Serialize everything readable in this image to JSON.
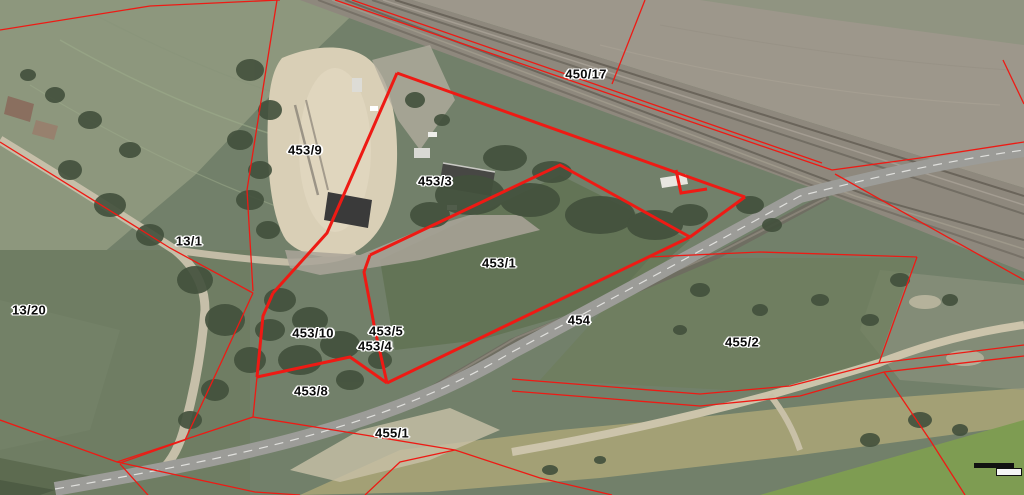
{
  "map": {
    "parcel_labels": [
      {
        "text": "450/17",
        "x": 586,
        "y": 74
      },
      {
        "text": "453/9",
        "x": 305,
        "y": 150
      },
      {
        "text": "453/3",
        "x": 435,
        "y": 181
      },
      {
        "text": "13/1",
        "x": 189,
        "y": 241
      },
      {
        "text": "453/1",
        "x": 499,
        "y": 263
      },
      {
        "text": "13/20",
        "x": 29,
        "y": 310
      },
      {
        "text": "454",
        "x": 579,
        "y": 320
      },
      {
        "text": "453/5",
        "x": 386,
        "y": 331
      },
      {
        "text": "453/10",
        "x": 313,
        "y": 333
      },
      {
        "text": "455/2",
        "x": 742,
        "y": 342
      },
      {
        "text": "453/4",
        "x": 375,
        "y": 346
      },
      {
        "text": "453/8",
        "x": 311,
        "y": 391
      },
      {
        "text": "455/1",
        "x": 392,
        "y": 433
      }
    ],
    "colors": {
      "boundary_red": "#ee1a14",
      "label_text": "#0b0b0b",
      "label_halo": "#ffffff"
    }
  }
}
